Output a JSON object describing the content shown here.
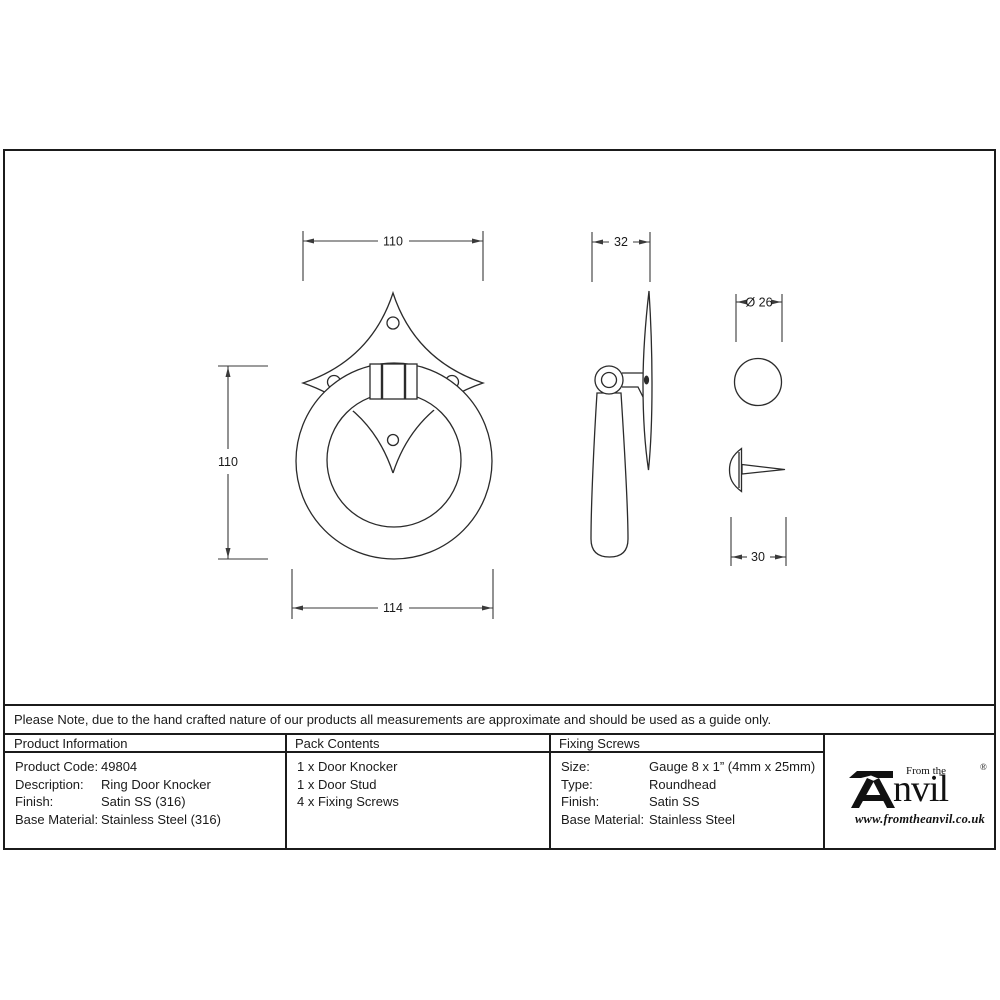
{
  "sheet": {
    "note": "Please Note, due to the hand crafted nature of our products all measurements are approximate and should be used as a guide only.",
    "drawing": {
      "front_view": {
        "dim_top": "110",
        "dim_left": "110",
        "dim_bottom": "114"
      },
      "side_view": {
        "dim_depth": "32"
      },
      "stud_view": {
        "dim_diameter": "Ø 26",
        "dim_length": "30"
      }
    },
    "columns": {
      "product_information": {
        "header": "Product Information",
        "rows": [
          {
            "label": "Product Code:",
            "value": "49804"
          },
          {
            "label": "Description:",
            "value": "Ring Door Knocker"
          },
          {
            "label": "Finish:",
            "value": "Satin SS (316)"
          },
          {
            "label": "Base Material:",
            "value": "Stainless Steel (316)"
          }
        ]
      },
      "pack_contents": {
        "header": "Pack Contents",
        "items": [
          "1 x Door Knocker",
          "1 x Door Stud",
          "4 x Fixing Screws"
        ]
      },
      "fixing_screws": {
        "header": "Fixing Screws",
        "rows": [
          {
            "label": "Size:",
            "value": "Gauge 8 x 1” (4mm x 25mm)"
          },
          {
            "label": "Type:",
            "value": "Roundhead"
          },
          {
            "label": "Finish:",
            "value": "Satin SS"
          },
          {
            "label": "Base Material:",
            "value": "Stainless Steel"
          }
        ]
      }
    },
    "logo": {
      "from_the": "From the",
      "name_rest": "nvil",
      "registered": "®",
      "website": "www.fromtheanvil.co.uk"
    },
    "colors": {
      "border": "#1b1b1b",
      "line": "#2b2b2b",
      "text": "#1a1a1a"
    }
  }
}
